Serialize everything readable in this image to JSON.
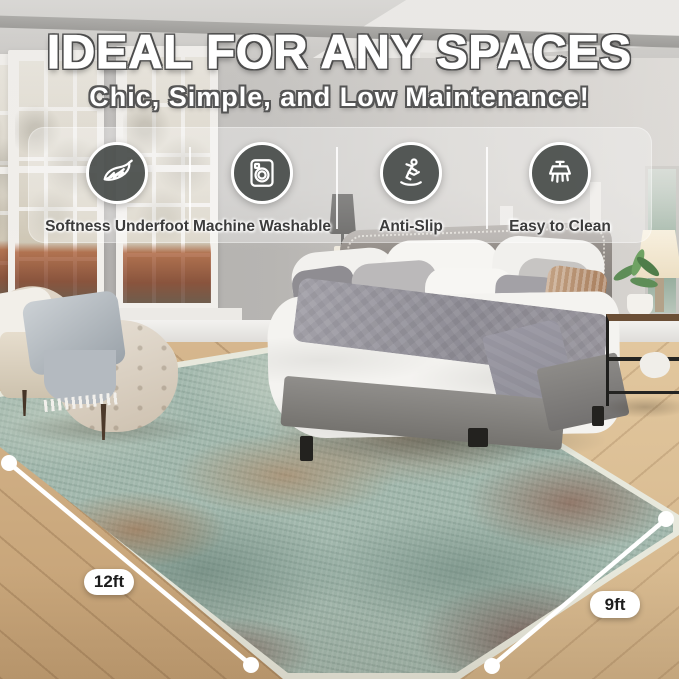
{
  "header": {
    "title": "IDEAL FOR ANY SPACES",
    "subtitle": "Chic, Simple, and Low Maintenance!"
  },
  "features": [
    {
      "label": "Softness Underfoot",
      "icon": "feather-icon"
    },
    {
      "label": "Machine Washable",
      "icon": "washing-machine-icon"
    },
    {
      "label": "Anti-Slip",
      "icon": "slipping-person-icon"
    },
    {
      "label": "Easy to Clean",
      "icon": "cleaning-brush-icon"
    }
  ],
  "measurements": {
    "width_label": "12ft",
    "depth_label": "9ft"
  },
  "colors": {
    "badge_circle": "#4a4f4d",
    "badge_ring": "#ffffff",
    "headline_text": "#ffffff",
    "headline_outline": "#4d4d4d",
    "feature_label_text": "#3c3c3c",
    "pill_background": "#ffffff",
    "pill_text": "#1c1c1c",
    "rug_base": "#a2b8ad",
    "rug_rust": "#a8643a",
    "rug_dark_teal": "#5c766c",
    "floor_wood": "#cba97e"
  }
}
